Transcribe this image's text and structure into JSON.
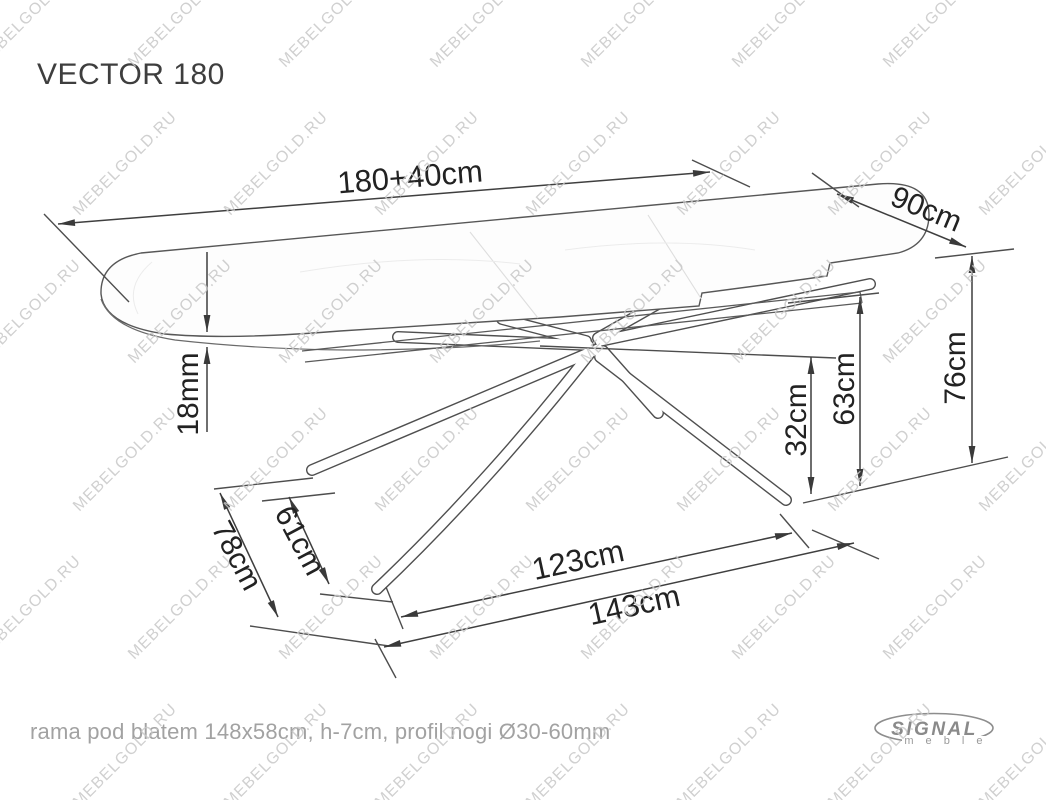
{
  "title": "VECTOR 180",
  "footer": {
    "note": "rama pod blatem 148x58cm, h-7cm, profil nogi Ø30-60mm"
  },
  "logo": {
    "brand": "SIGNAL",
    "sub": "m e b l e"
  },
  "watermark": {
    "text": "MEBELGOLD.RU"
  },
  "colors": {
    "outline": "#575757",
    "ext_line": "#4d4d4d",
    "dim_line": "#3f3f3f",
    "arrow": "#3a3a3a",
    "label": "#222222",
    "faint_seam": "#dedede",
    "watermark": "#c8c8c8",
    "footer_text": "#a2a2a2",
    "logo_gray": "#8a8a8a"
  },
  "dimensions": [
    {
      "id": "length-total",
      "text": "180+40cm",
      "x1": 58,
      "y1": 224,
      "x2": 710,
      "y2": 172,
      "heads": "both",
      "label": {
        "x": 410,
        "y": 177,
        "rot": -4.8,
        "size": 31
      }
    },
    {
      "id": "depth",
      "text": "90cm",
      "x1": 837,
      "y1": 194,
      "x2": 966,
      "y2": 247,
      "heads": "both",
      "label": {
        "x": 926,
        "y": 210,
        "rot": 22.5,
        "size": 30
      }
    },
    {
      "id": "height-total",
      "text": "76cm",
      "x1": 972,
      "y1": 256,
      "x2": 972,
      "y2": 463,
      "heads": "both",
      "label": {
        "x": 956,
        "y": 368,
        "rot": -90,
        "size": 30
      }
    },
    {
      "id": "height-frame",
      "text": "63cm",
      "x1": 860,
      "y1": 297,
      "x2": 860,
      "y2": 486,
      "heads": "both",
      "label": {
        "x": 845,
        "y": 389,
        "rot": -90,
        "size": 30
      }
    },
    {
      "id": "height-cross",
      "text": "32cm",
      "x1": 811,
      "y1": 357,
      "x2": 811,
      "y2": 494,
      "heads": "both",
      "label": {
        "x": 797,
        "y": 420,
        "rot": -90,
        "size": 30
      }
    },
    {
      "id": "top-thickness-upper",
      "text": "",
      "x1": 207,
      "y1": 252,
      "x2": 207,
      "y2": 332,
      "heads": "end",
      "label": null
    },
    {
      "id": "top-thickness-lower",
      "text": "18mm",
      "x1": 207,
      "y1": 347,
      "x2": 207,
      "y2": 432,
      "heads": "start",
      "label": {
        "x": 189,
        "y": 394,
        "rot": -90,
        "size": 30
      }
    },
    {
      "id": "base-inner",
      "text": "61cm",
      "x1": 289,
      "y1": 497,
      "x2": 329,
      "y2": 584,
      "heads": "both",
      "label": {
        "x": 299,
        "y": 541,
        "rot": 62,
        "size": 30
      }
    },
    {
      "id": "base-depth",
      "text": "78cm",
      "x1": 220,
      "y1": 493,
      "x2": 278,
      "y2": 617,
      "heads": "both",
      "label": {
        "x": 236,
        "y": 556,
        "rot": 62,
        "size": 30
      }
    },
    {
      "id": "base-width-inner",
      "text": "123cm",
      "x1": 401,
      "y1": 617,
      "x2": 792,
      "y2": 533,
      "heads": "both",
      "label": {
        "x": 578,
        "y": 560,
        "rot": -12.2,
        "size": 31
      }
    },
    {
      "id": "base-width-outer",
      "text": "143cm",
      "x1": 384,
      "y1": 647,
      "x2": 854,
      "y2": 543,
      "heads": "both",
      "label": {
        "x": 634,
        "y": 605,
        "rot": -12.4,
        "size": 31
      }
    }
  ],
  "extension_lines": [
    [
      44,
      214,
      129,
      302
    ],
    [
      692,
      160,
      750,
      187
    ],
    [
      812,
      173,
      859,
      207
    ],
    [
      935,
      258,
      1014,
      249
    ],
    [
      788,
      303,
      879,
      293
    ],
    [
      540,
      346,
      836,
      358
    ],
    [
      803,
      503,
      1008,
      457
    ],
    [
      214,
      489,
      313,
      478
    ],
    [
      262,
      501,
      335,
      493
    ],
    [
      250,
      626,
      389,
      646
    ],
    [
      320,
      594,
      393,
      602
    ],
    [
      386,
      587,
      403,
      629
    ],
    [
      375,
      639,
      396,
      678
    ],
    [
      780,
      514,
      809,
      548
    ],
    [
      812,
      530,
      879,
      559
    ]
  ],
  "drawing": {
    "tabletop_path": "M141,253 L878,184 Q930,180 929,216 Q928,245 898,253 L830,263 L827,276 L763,285 L702,293 L699,306 L560,317 L340,331 Q230,340 165,334 Q104,325 101,294 Q100,261 141,253 Z",
    "bottom_edge_path": "M101,299 Q112,330 175,340 Q255,349 345,350 Q455,350 540,341",
    "frame_path": "M302,351 L860,292 M305,362 L862,303 M860,292 L862,303",
    "seam_paths": "M470,232 L538,318 M648,215 L702,300",
    "vein_paths": "M300,272 Q420,252 520,264 M565,250 Q670,236 755,250 M152,262 Q124,286 138,314",
    "legs": [
      "M598,349 L312,470",
      "M590,353 C530,430 455,515 377,589",
      "M600,357 L786,500",
      "M603,351 L658,413",
      "M588,345 L398,337",
      "M586,341 L502,319",
      "M600,341 L870,284",
      "M598,338 L656,305"
    ]
  },
  "watermark_grid": {
    "rows": 6,
    "cols": 7,
    "x_step": 151,
    "y_step": 148,
    "x0": 20,
    "y0": 8,
    "odd_row_offset": 96
  }
}
